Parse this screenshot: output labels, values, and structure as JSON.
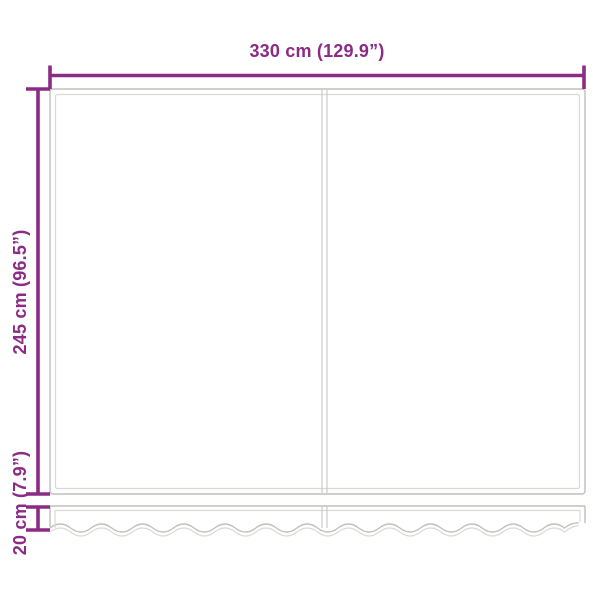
{
  "diagram": {
    "colors": {
      "dimension_accent": "#8b2b85",
      "outline_gray": "#c2bfbc",
      "outline_light_gray": "#dbd9d7",
      "seam_gray": "#cecbc9",
      "background": "#ffffff"
    },
    "labels": {
      "width": "330 cm (129.9”)",
      "height": "245 cm (96.5”)",
      "valance_height": "20 cm (7.9”)"
    }
  }
}
